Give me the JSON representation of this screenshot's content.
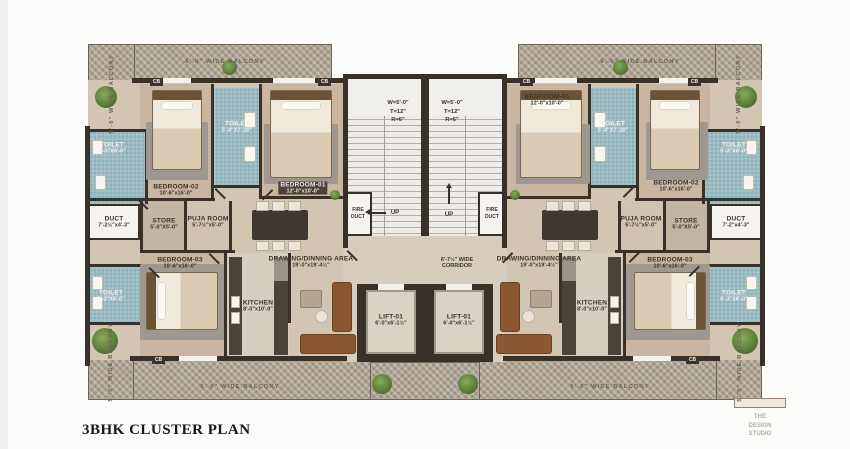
{
  "title": "3BHK CLUSTER PLAN",
  "watermark": {
    "line1": "THE",
    "line2": "DESIGN",
    "line3": "STUDIO"
  },
  "colors": {
    "wall": "#38312a",
    "floor": "#d2c5b2",
    "bedroom_floor": "#c9b6a0",
    "toilet_tile": "#8db2ba",
    "balcony": "#aea494",
    "stair_tread": "#edece8",
    "sofa_brown": "#8a5730",
    "plant_green": "#5e7f3c",
    "title_text": "#15161a"
  },
  "balconies": {
    "top_left": "6'-0\" WIDE BALCONY",
    "top_right": "6'-0\" WIDE BALCONY",
    "bottom_left": "6'-0\" WIDE BALCONY",
    "bottom_right": "6'-0\" WIDE BALCONY",
    "side_left_upper": "5'-0\" WIDE BALCONY",
    "side_left_lower": "5'-0\" WIDE BALCONY",
    "side_right_upper": "5'-0\" WIDE BALCONY",
    "side_right_lower": "5'-0\" WIDE BALCONY"
  },
  "core": {
    "stair_left": {
      "w": "W=5'-0\"",
      "t": "T=12\"",
      "r": "R=6\""
    },
    "stair_right": {
      "w": "W=5'-0\"",
      "t": "T=12\"",
      "r": "R=6\""
    },
    "up_left": "UP",
    "up_right": "UP",
    "fire_duct_left": {
      "line1": "FIRE",
      "line2": "DUCT"
    },
    "fire_duct_right": {
      "line1": "FIRE",
      "line2": "DUCT"
    },
    "corridor": {
      "line1": "6'-7½\" WIDE",
      "line2": "CORRIDOR"
    },
    "lift_left": {
      "name": "LIFT-01",
      "dims": "6'-0\"x6'-1½\""
    },
    "lift_right": {
      "name": "LIFT-01",
      "dims": "6'-0\"x6'-1½\""
    }
  },
  "left_unit": {
    "bedroom01": {
      "name": "BEDROOM-01",
      "dims": "12'-0\"x10'-0\""
    },
    "bedroom02": {
      "name": "BEDROOM-02",
      "dims": "10'-6\"x16'-0\""
    },
    "bedroom03": {
      "name": "BEDROOM-03",
      "dims": "10'-6\"x16'-0\""
    },
    "toilet_attached": {
      "name": "TOILET",
      "dims": "5'-4\"X7'-10\""
    },
    "toilet_upper": {
      "name": "TOILET",
      "dims": "5'-3\"X6'-0\""
    },
    "toilet_lower": {
      "name": "TOILET",
      "dims": "5'-3\"X6'-0\""
    },
    "duct": {
      "name": "DUCT",
      "dims": "7'-2½\"x4'-3\""
    },
    "store": {
      "name": "STORE",
      "dims": "5'-0\"X5'-0\""
    },
    "puja": {
      "name": "PUJA ROOM",
      "dims": "5'-7½\"x5'-0\""
    },
    "drawing": {
      "name": "DRAWING/DINNING AREA",
      "dims": "19'-0\"x19'-4½\""
    },
    "kitchen": {
      "name": "KITCHEN",
      "dims": "8'-0\"x10'-0\""
    },
    "cupboard": "CB"
  },
  "right_unit": {
    "bedroom01": {
      "name": "BEDROOM-01",
      "dims": "12'-0\"x10'-0\""
    },
    "bedroom02": {
      "name": "BEDROOM-02",
      "dims": "10'-6\"x16'-0\""
    },
    "bedroom03": {
      "name": "BEDROOM-03",
      "dims": "10'-6\"x16'-0\""
    },
    "toilet_attached": {
      "name": "TOILET",
      "dims": "5'-4\"X7'-10\""
    },
    "toilet_upper": {
      "name": "TOILET",
      "dims": "5'-3\"X6'-0\""
    },
    "toilet_lower": {
      "name": "TOILET",
      "dims": "5'-3\"X6'-0\""
    },
    "duct": {
      "name": "DUCT",
      "dims": "7'-2\"x4'-3\""
    },
    "store": {
      "name": "STORE",
      "dims": "5'-0\"X5'-0\""
    },
    "puja": {
      "name": "PUJA ROOM",
      "dims": "5'-7½\"x5'-0\""
    },
    "drawing": {
      "name": "DRAWING/DINNING AREA",
      "dims": "19'-0\"x19'-4½\""
    },
    "kitchen": {
      "name": "KITCHEN",
      "dims": "8'-0\"x10'-0\""
    },
    "cupboard": "CB"
  }
}
